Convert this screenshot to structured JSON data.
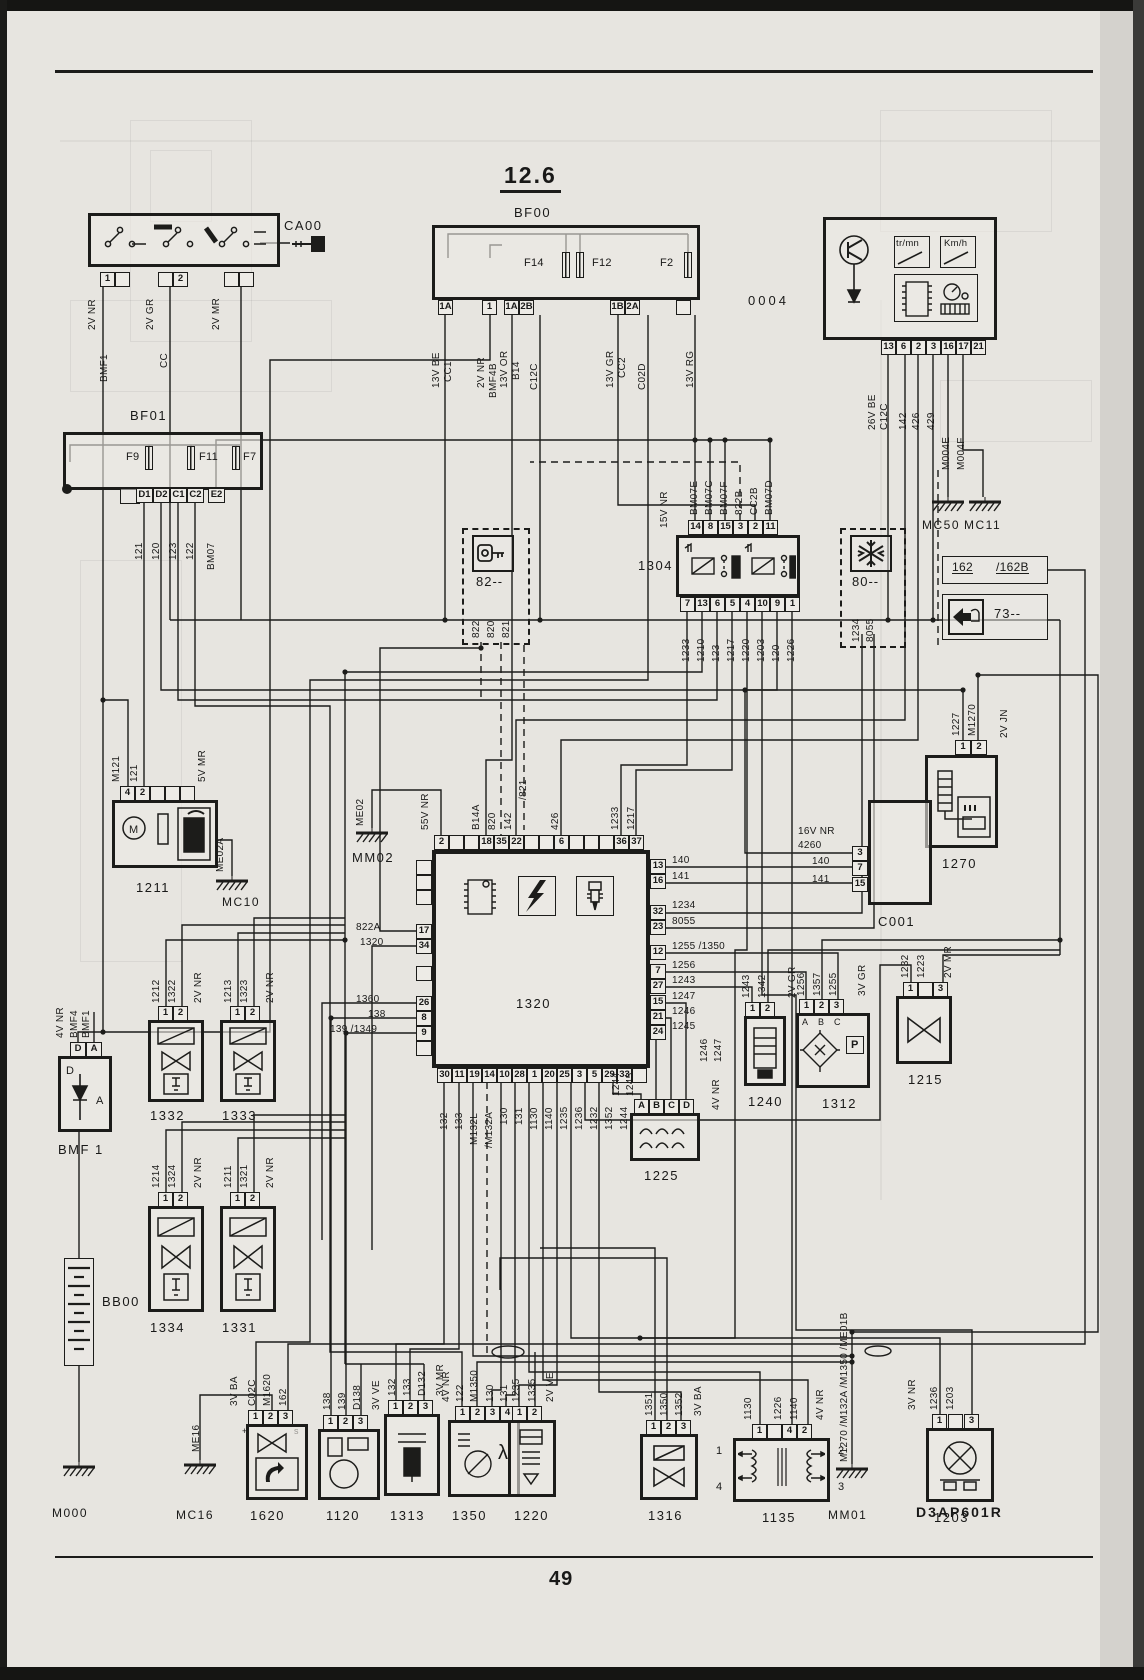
{
  "page": {
    "title": "12.6",
    "number": "49",
    "ref": "D3AP601R"
  },
  "ca00": {
    "id": "CA00",
    "pin1": "1",
    "pin2": "2",
    "w1": "2V NR",
    "w1n": "BMF1",
    "w2": "2V GR",
    "w2n": "CC",
    "w3": "2V MR"
  },
  "bf00": {
    "id": "BF00",
    "f14": "F14",
    "f12": "F12",
    "f2": "F2",
    "p1": "1A",
    "p2": "1",
    "p3": "1A",
    "p4": "2B",
    "p5": "1B",
    "p6": "2A",
    "w1": "13V BE",
    "w1n": "CC1",
    "w2": "2V NR",
    "w2n": "BMF4B",
    "w3": "13V OR",
    "w3n": "B14",
    "w4": "C12C",
    "w5": "13V GR",
    "w5n": "CC2",
    "w6": "C02D",
    "w7": "13V RG"
  },
  "cluster": {
    "id": "0004",
    "tr": "tr/mn",
    "km": "Km/h",
    "pins": [
      "13",
      "6",
      "2",
      "3",
      "16",
      "17",
      "21"
    ],
    "w1": "26V BE",
    "w1n": "C12C",
    "w2": "142",
    "w3": "426",
    "w4": "429",
    "w5": "M004E",
    "w6": "M004F"
  },
  "bf01": {
    "id": "BF01",
    "f9": "F9",
    "f11": "F11",
    "f7": "F7",
    "pins": [
      "D1",
      "D2",
      "C1",
      "C2",
      "E2"
    ],
    "w": [
      "121",
      "120",
      "123",
      "122",
      "BM07"
    ]
  },
  "box82": {
    "id": "82--",
    "w": [
      "822",
      "820",
      "821"
    ]
  },
  "relay": {
    "id": "1304",
    "v": "15V NR",
    "tp": [
      "14",
      "8",
      "15",
      "3",
      "2",
      "11"
    ],
    "tw": [
      "BM07E",
      "BM07C",
      "BM07F",
      "822B",
      "CC2B",
      "BM07D"
    ],
    "bp": [
      "7",
      "13",
      "6",
      "5",
      "4",
      "10",
      "9",
      "1"
    ],
    "bw": [
      "1233",
      "1210",
      "123",
      "1217",
      "1220",
      "1203",
      "120",
      "1226"
    ]
  },
  "box80": {
    "id": "80--",
    "w1": "1234",
    "w2": "8055"
  },
  "gnd": {
    "mc50": "MC50",
    "mc11": "MC11",
    "m004e": "M004E",
    "me01a": "ME01A",
    "mm02": "MM02",
    "me02": "ME02",
    "mc10": "MC10",
    "me02a": "ME02A",
    "m000": "M000",
    "mc16": "MC16",
    "me16": "ME16",
    "mm01": "MM01",
    "bus": "M1270 /M132A /M1350 /ME01B"
  },
  "box162": {
    "a": "162",
    "b": "/162B"
  },
  "box73": {
    "id": "73--"
  },
  "r1270": {
    "id": "1270",
    "p1": "1",
    "p2": "2",
    "w1": "1227",
    "w2": "M1270",
    "v": "2V JN"
  },
  "pump": {
    "id": "1211",
    "p1": "4",
    "p2": "2",
    "w1": "M121",
    "w2": "121",
    "v": "5V MR"
  },
  "ecu": {
    "id": "1320",
    "p2": "2",
    "v55": "55V NR",
    "me02": "ME02",
    "p18": "18",
    "p35": "35",
    "p22": "22",
    "b14a": "B14A",
    "w820": "820",
    "w142": "142",
    "w821": "/821",
    "p6": "6",
    "w426": "426",
    "p36": "36",
    "p37": "37",
    "w1233": "1233",
    "w1217": "1217",
    "p17": "17",
    "p34": "34",
    "w822a": "822A",
    "w1320": "1320",
    "p26": "26",
    "p8": "8",
    "p9": "9",
    "w1360": "1360",
    "w138": "138",
    "w139": "139  /1349",
    "p13": "13",
    "p16": "16",
    "w140": "140",
    "w141": "141",
    "p32": "32",
    "p23": "23",
    "w1234": "1234",
    "w8055": "8055",
    "p12": "12",
    "w1255": "1255  /1350",
    "p7": "7",
    "w1256": "1256",
    "p27": "27",
    "w1243": "1243",
    "p15": "15",
    "w1247": "1247",
    "p21": "21",
    "w1246": "1246",
    "p24": "24",
    "w1245": "1245",
    "bp": [
      "30",
      "11",
      "19",
      "14",
      "10",
      "28",
      "1",
      "20",
      "25",
      "3",
      "5",
      "29",
      "33"
    ],
    "bw": [
      "132",
      "133",
      "M132L",
      "/M132A",
      "130",
      "131",
      "1130",
      "1140",
      "1235",
      "1236",
      "1232",
      "1352",
      "1244"
    ]
  },
  "c001": {
    "id": "C001",
    "v": "16V NR",
    "w4260": "4260",
    "w140": "140",
    "w141": "141",
    "p3": "3",
    "p7": "7",
    "p15": "15"
  },
  "r1240": {
    "id": "1240",
    "w1": "1243",
    "w2": "1342",
    "v": "2V GR",
    "p1": "1",
    "p2": "2"
  },
  "r1312": {
    "id": "1312",
    "w1": "1256",
    "w2": "1357",
    "w3": "1255",
    "v": "3V GR",
    "p1": "1",
    "p2": "2",
    "p3": "3",
    "a": "A",
    "b": "B",
    "c": "C",
    "p": "P"
  },
  "r1215": {
    "id": "1215",
    "w1": "1232",
    "w2": "1223",
    "v": "2V MR",
    "p1": "1",
    "p3": "3"
  },
  "r1225": {
    "id": "1225",
    "v": "4V NR",
    "w": [
      "1244",
      "1245",
      "1246",
      "1247"
    ],
    "pins": [
      "A",
      "B",
      "C",
      "D"
    ]
  },
  "inj1332": {
    "id": "1332",
    "w1": "1212",
    "w2": "1322",
    "v": "2V NR",
    "p1": "1",
    "p2": "2"
  },
  "inj1333": {
    "id": "1333",
    "w1": "1213",
    "w2": "1323",
    "v": "2V NR",
    "p1": "1",
    "p2": "2"
  },
  "inj1334": {
    "id": "1334",
    "w1": "1214",
    "w2": "1324",
    "v": "2V NR",
    "p1": "1",
    "p2": "2"
  },
  "inj1331": {
    "id": "1331",
    "w1": "1211",
    "w2": "1321",
    "v": "2V NR",
    "p1": "1",
    "p2": "2"
  },
  "dbox": {
    "id": "BMF 1",
    "v": "4V NR",
    "w1": "BMF4",
    "w2": "BMF1",
    "pd": "D",
    "pa": "A",
    "d": "D",
    "a": "A"
  },
  "bb00": {
    "id": "BB00"
  },
  "r1620": {
    "id": "1620",
    "w1": "C02C",
    "w2": "M1620",
    "w3": "162",
    "v": "3V BA",
    "p1": "1",
    "p2": "2",
    "p3": "3",
    "plus": "+",
    "s": "s"
  },
  "r1120": {
    "id": "1120",
    "w1": "138",
    "w2": "139",
    "w3": "D138",
    "v": "3V VE",
    "p1": "1",
    "p2": "2",
    "p3": "3"
  },
  "r1313": {
    "id": "1313",
    "w1": "132",
    "w2": "133",
    "w3": "D132",
    "v": "3V MR",
    "p1": "1",
    "p2": "2",
    "p3": "3"
  },
  "r1350": {
    "id": "1350",
    "v": "4V NR",
    "w1": "122",
    "w2": "M1350",
    "w3": "130",
    "w4": "131",
    "p1": "1",
    "p2": "2",
    "p3": "3",
    "p4": "4",
    "lambda": "λ"
  },
  "r1220": {
    "id": "1220",
    "w1": "1235",
    "w2": "1335",
    "v": "2V VE",
    "p1": "1",
    "p2": "2"
  },
  "r1316": {
    "id": "1316",
    "w1": "1351",
    "w2": "1350",
    "w3": "1352",
    "v": "3V BA",
    "p1": "1",
    "p2": "2",
    "p3": "3"
  },
  "r1135": {
    "id": "1135",
    "w1": "1130",
    "w2": "1226",
    "w3": "1140",
    "v": "4V NR",
    "p1": "1",
    "p4": "4",
    "p2": "2",
    "t1": "1",
    "t2": "2",
    "t3": "3",
    "t4": "4"
  },
  "r1203": {
    "id": "1203",
    "w1": "1236",
    "w2": "1203",
    "v": "3V NR",
    "p1": "1",
    "p3": "3"
  }
}
